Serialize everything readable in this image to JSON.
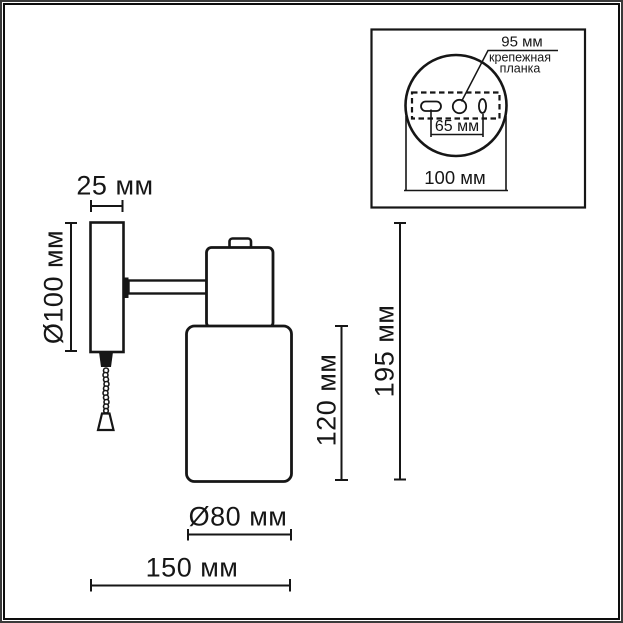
{
  "colors": {
    "line": "#161616",
    "background": "#ffffff"
  },
  "main_view": {
    "dim_plate_depth": "25 мм",
    "dim_plate_diameter": "Ø100 мм",
    "dim_shade_height": "120 мм",
    "dim_total_height": "195 мм",
    "dim_shade_diameter": "Ø80 мм",
    "dim_total_depth": "150 мм"
  },
  "inset_view": {
    "dim_bracket_length": "95 мм",
    "label_bracket_line1": "крепежная",
    "label_bracket_line2": "планка",
    "dim_hole_spacing": "65 мм",
    "dim_plate_diameter": "100 мм"
  }
}
